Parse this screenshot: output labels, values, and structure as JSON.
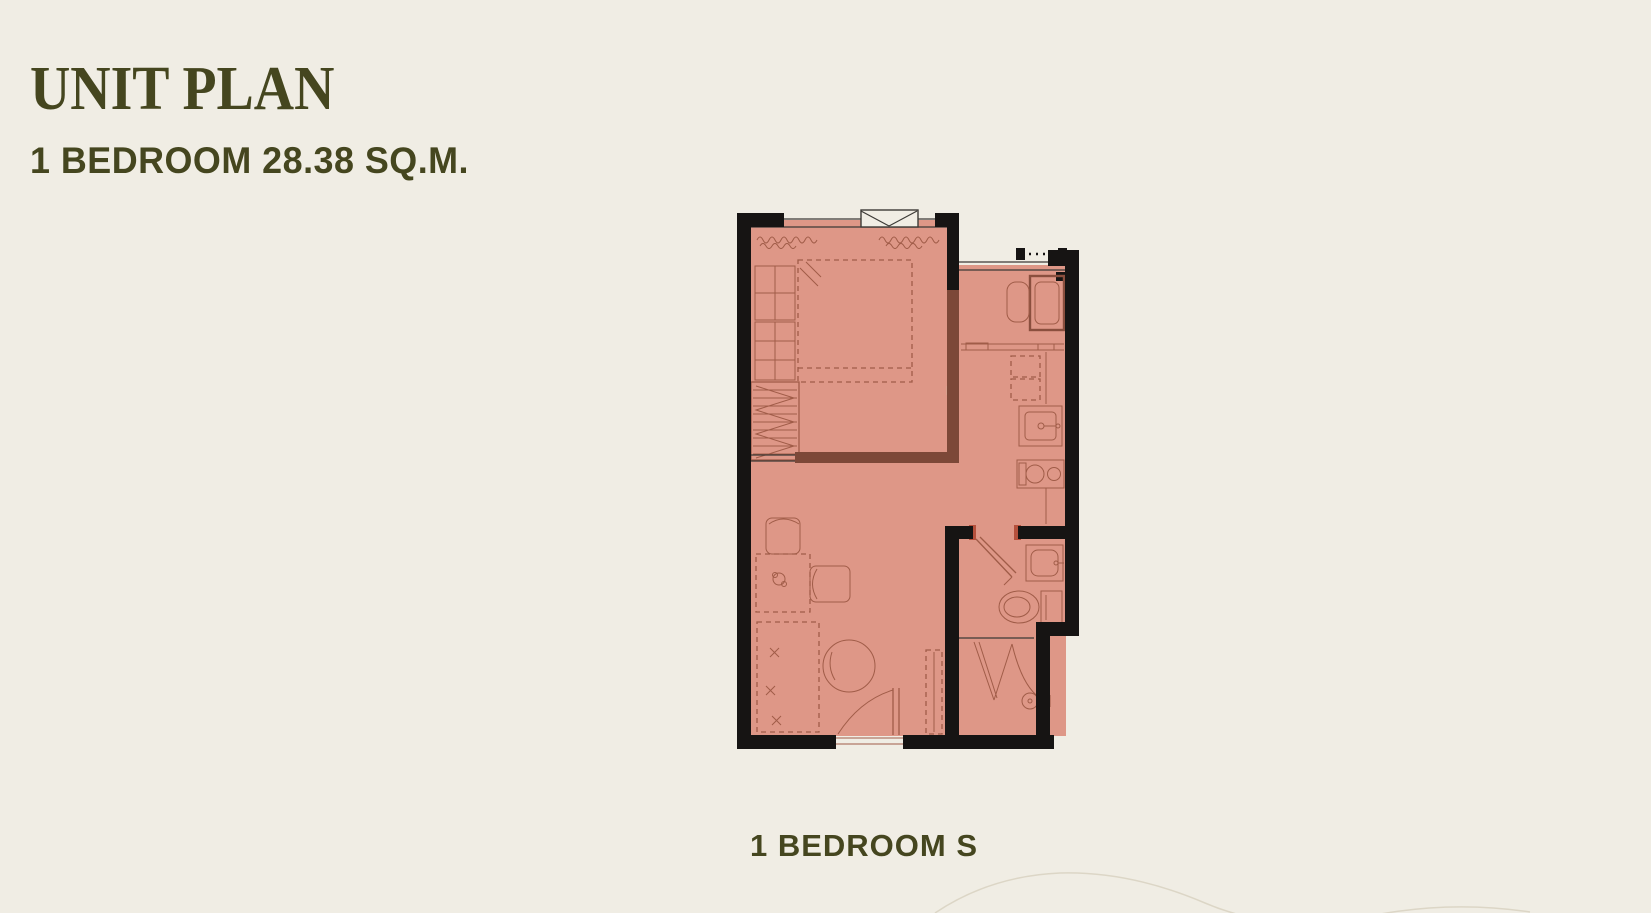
{
  "page": {
    "title": "UNIT PLAN",
    "subtitle": "1 BEDROOM 28.38 SQ.M."
  },
  "unit": {
    "caption": "1 BEDROOM S",
    "bedrooms": "1",
    "area_sqm": "28.38"
  },
  "floor_plan": {
    "features": [
      "bedroom-window",
      "curtains",
      "double-bed",
      "nightstand-dresser",
      "wardrobe",
      "ac-ledge-railing",
      "washing-machine",
      "kitchen-counter",
      "refrigerator",
      "kitchen-sink",
      "two-burner-stove",
      "dining-chairs",
      "dining-table",
      "tv-console",
      "coffee-table",
      "shoe-cabinet",
      "entrance-door",
      "bathroom-door",
      "washbasin",
      "toilet",
      "shower"
    ]
  },
  "colors": {
    "background": "#f0ede4",
    "text": "#45461f",
    "plan_fill": "#de9787",
    "wall": "#161413",
    "partition": "#7c4838",
    "line": "#a05c48",
    "dark_line": "#8a4f3e",
    "window_line": "#3c3a36",
    "door_accent": "#b5503c",
    "contour": "#dcd6c6",
    "partition_light": "#d8a08e"
  }
}
